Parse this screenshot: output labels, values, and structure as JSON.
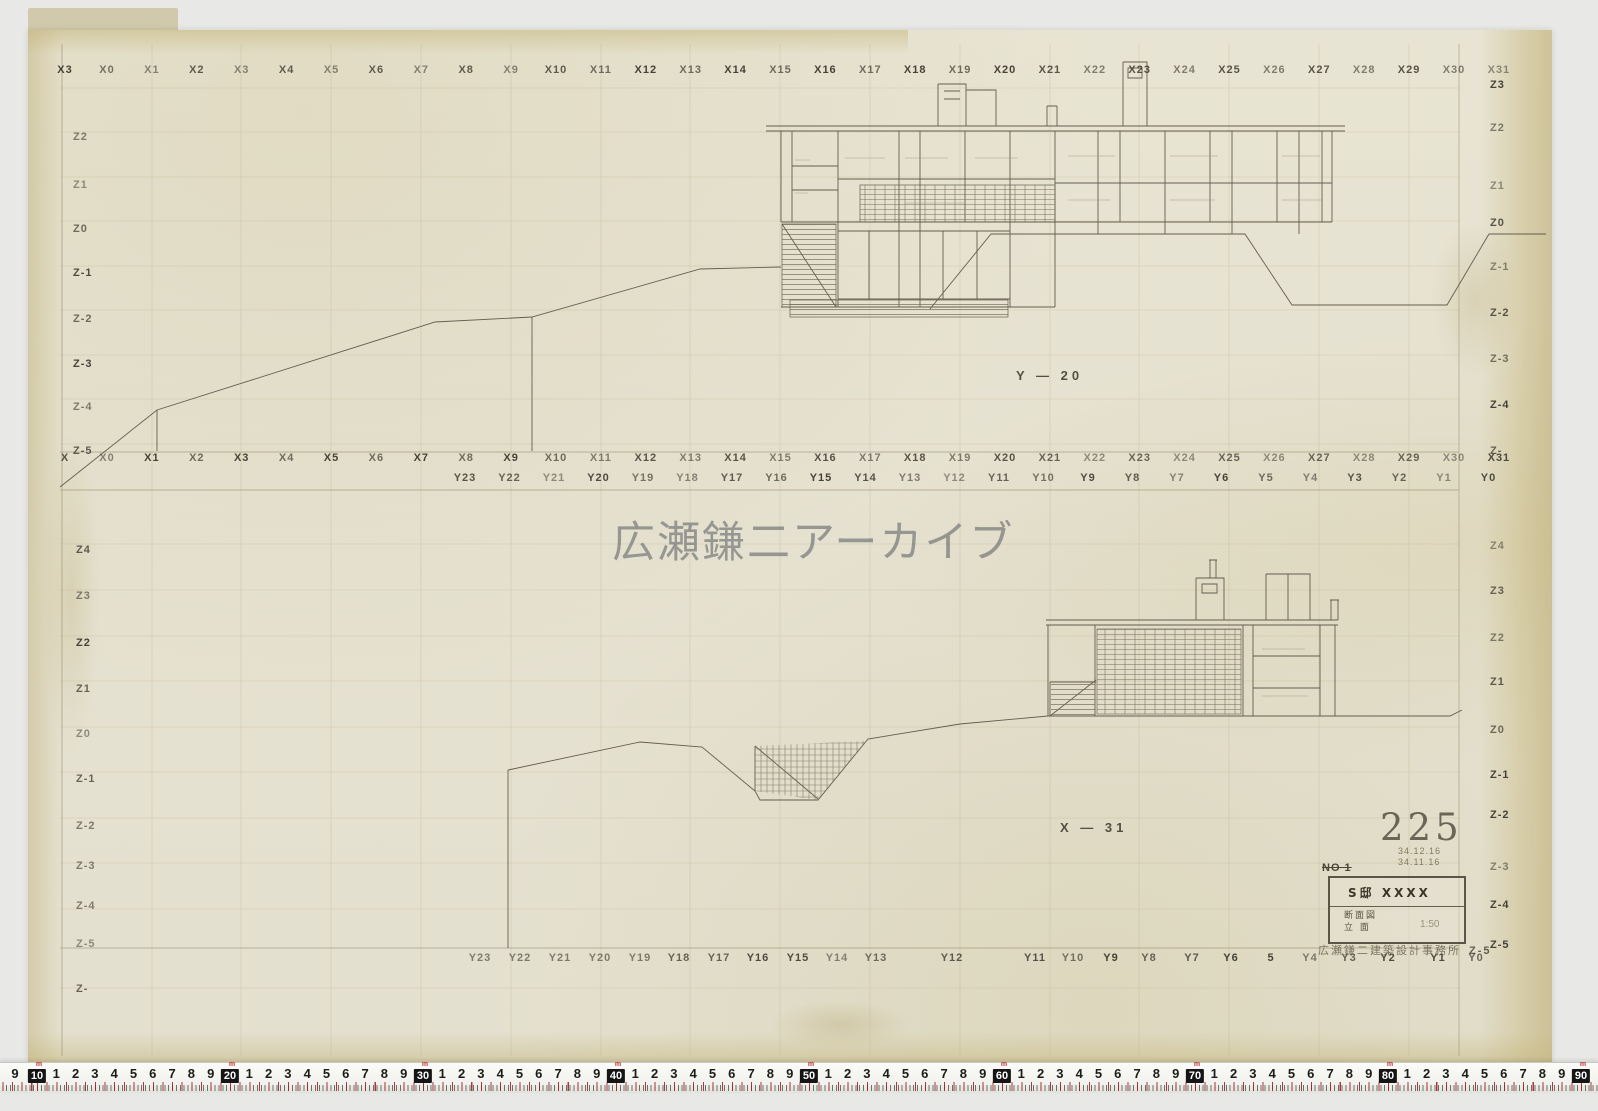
{
  "watermark": "広瀬鎌二アーカイブ",
  "sheet_number": "225",
  "sections": {
    "upper_label": "Y — 20",
    "lower_label": "X — 31"
  },
  "grid": {
    "top_x": [
      "X3",
      "X0",
      "X1",
      "X2",
      "X3",
      "X4",
      "X5",
      "X6",
      "X7",
      "X8",
      "X9",
      "X10",
      "X11",
      "X12",
      "X13",
      "X14",
      "X15",
      "X16",
      "X17",
      "X18",
      "X19",
      "X20",
      "X21",
      "X22",
      "X23",
      "X24",
      "X25",
      "X26",
      "X27",
      "X28",
      "X29",
      "X30",
      "X31"
    ],
    "mid_x": [
      "X",
      "X0",
      "X1",
      "X2",
      "X3",
      "X4",
      "X5",
      "X6",
      "X7",
      "X8",
      "X9",
      "X10",
      "X11",
      "X12",
      "X13",
      "X14",
      "X15",
      "X16",
      "X17",
      "X18",
      "X19",
      "X20",
      "X21",
      "X22",
      "X23",
      "X24",
      "X25",
      "X26",
      "X27",
      "X28",
      "X29",
      "X30",
      "X31"
    ],
    "mid_y": [
      "Y23",
      "Y22",
      "Y21",
      "Y20",
      "Y19",
      "Y18",
      "Y17",
      "Y16",
      "Y15",
      "Y14",
      "Y13",
      "Y12",
      "Y11",
      "Y10",
      "Y9",
      "Y8",
      "Y7",
      "Y6",
      "Y5",
      "Y4",
      "Y3",
      "Y2",
      "Y1",
      "Y0"
    ],
    "bottom_y": [
      "Y23",
      "Y22",
      "Y21",
      "Y20",
      "Y19",
      "Y18",
      "Y17",
      "Y16",
      "Y15",
      "Y14",
      "Y13",
      "Y12",
      "Y11",
      "Y10",
      "Y9",
      "Y8",
      "Y7",
      "Y6",
      "5",
      "Y4",
      "Y3",
      "Y2",
      "Y1",
      "Y0"
    ],
    "left_z_upper": [
      "Z2",
      "Z1",
      "Z0",
      "Z-1",
      "Z-2",
      "Z-3",
      "Z-4",
      "Z-5"
    ],
    "right_z_upper": [
      "Z3",
      "Z2",
      "Z1",
      "Z0",
      "Z-1",
      "Z-2",
      "Z-3",
      "Z-4",
      "Z-"
    ],
    "left_z_lower": [
      "Z4",
      "Z3",
      "Z2",
      "Z1",
      "Z0",
      "Z-1",
      "Z-2",
      "Z-3",
      "Z-4",
      "Z-5",
      "Z-"
    ],
    "right_z_lower": [
      "Z4",
      "Z3",
      "Z2",
      "Z1",
      "Z0",
      "Z-1",
      "Z-2",
      "Z-3",
      "Z-4",
      "Z-5"
    ]
  },
  "stamp": {
    "no_label": "NO 1",
    "date_line1": "34.12.16",
    "date_line2": "34.11.16",
    "project": "S邸 XXXX",
    "drawing_type": "断面図",
    "drawing_type2": "立 面",
    "scale": "1:50",
    "office": "広瀬鎌二建築設計事務所",
    "corner_z": "Z-5"
  },
  "ruler": {
    "lead_digit": "9",
    "digits": [
      "1",
      "2",
      "3",
      "4",
      "5",
      "6",
      "7",
      "8",
      "9"
    ],
    "decades": [
      "10",
      "20",
      "30",
      "40",
      "50",
      "60",
      "70",
      "80",
      "90"
    ],
    "decade_mark": "m"
  }
}
